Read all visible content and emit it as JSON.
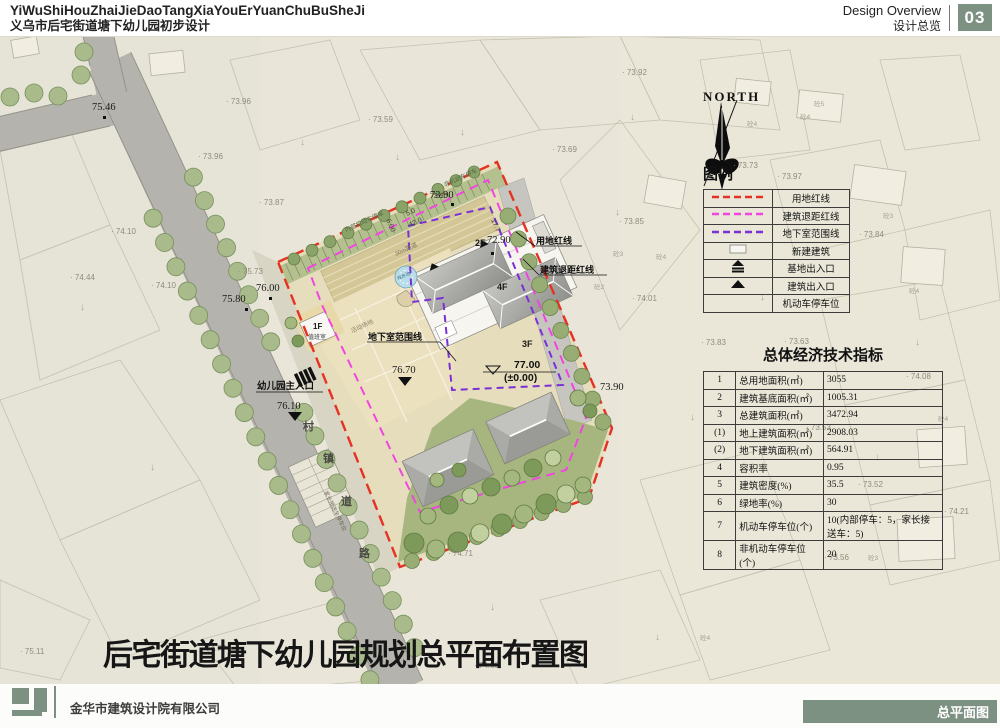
{
  "header": {
    "title_pinyin": "YiWuShiHouZhaiJieDaoTangXiaYouErYuanChuBuSheJi",
    "title_cn": "义乌市后宅街道塘下幼儿园初步设计",
    "section_en": "Design Overview",
    "section_cn": "设计总览",
    "page_no": "03"
  },
  "legend": {
    "title": "图例",
    "rows": [
      {
        "symbol": "red-dash",
        "label": "用地红线"
      },
      {
        "symbol": "magenta-dash",
        "label": "建筑退距红线"
      },
      {
        "symbol": "purple-dash",
        "label": "地下室范围线"
      },
      {
        "symbol": "new-building",
        "label": "新建建筑"
      },
      {
        "symbol": "site-entrance",
        "label": "基地出入口"
      },
      {
        "symbol": "building-entrance",
        "label": "建筑出入口"
      },
      {
        "symbol": "parking",
        "label": "机动车停车位"
      }
    ]
  },
  "indicators": {
    "title": "总体经济技术指标",
    "rows": [
      [
        "1",
        "总用地面积(㎡)",
        "3055"
      ],
      [
        "2",
        "建筑基底面积(㎡)",
        "1005.31"
      ],
      [
        "3",
        "总建筑面积(㎡)",
        "3472.94"
      ],
      [
        "(1)",
        "地上建筑面积(㎡)",
        "2908.03"
      ],
      [
        "(2)",
        "地下建筑面积(㎡)",
        "564.91"
      ],
      [
        "4",
        "容积率",
        "0.95"
      ],
      [
        "5",
        "建筑密度(%)",
        "35.5"
      ],
      [
        "6",
        "绿地率(%)",
        "30"
      ],
      [
        "7",
        "机动车停车位(个)",
        "10(内部停车：5，家长接送车：5)"
      ],
      [
        "8",
        "非机动车停车位(个)",
        "20"
      ]
    ]
  },
  "plan": {
    "title": "后宅街道塘下幼儿园规划总平面布置图",
    "north_label": "NORTH",
    "labels": [
      {
        "t": "NORTH",
        "x": 703,
        "y": 101,
        "s": 13,
        "r": 0,
        "c": "#111",
        "w": 700,
        "f": "serif",
        "ls": 2
      },
      {
        "t": "用地红线",
        "x": 536,
        "y": 244,
        "s": 9,
        "r": 0,
        "c": "#111",
        "w": 600
      },
      {
        "t": "建筑退距红线",
        "x": 540,
        "y": 273,
        "s": 9,
        "r": 0,
        "c": "#111",
        "w": 600
      },
      {
        "t": "地下室范围线",
        "x": 368,
        "y": 340,
        "s": 9,
        "r": 0,
        "c": "#111",
        "w": 700
      },
      {
        "t": "幼儿园主入口",
        "x": 257,
        "y": 389,
        "s": 9.5,
        "r": 0,
        "c": "#111",
        "w": 700
      },
      {
        "t": "活动场地",
        "x": 352,
        "y": 333,
        "s": 6,
        "r": -24.5,
        "c": "#8d8569",
        "w": 400
      },
      {
        "t": "30m跑道",
        "x": 396,
        "y": 256,
        "s": 6,
        "r": -24.5,
        "c": "#7c7659",
        "w": 400
      },
      {
        "t": "内部机动车停车",
        "x": 346,
        "y": 232,
        "s": 6,
        "r": -24.5,
        "c": "#55653f",
        "w": 400
      },
      {
        "t": "非机动车停车",
        "x": 445,
        "y": 187,
        "s": 6,
        "r": -24.5,
        "c": "#55653f",
        "w": 400
      },
      {
        "t": "家长接送车停车位",
        "x": 324,
        "y": 492,
        "s": 5.5,
        "r": 64,
        "c": "#6f6a55",
        "w": 400
      },
      {
        "t": "戏水池",
        "x": 398,
        "y": 280,
        "s": 4.5,
        "r": -24.5,
        "c": "#2e6577",
        "w": 400
      },
      {
        "t": "1F",
        "x": 313,
        "y": 329,
        "s": 8,
        "r": 0,
        "c": "#1a1a1a",
        "w": 700
      },
      {
        "t": "值班室",
        "x": 308,
        "y": 339,
        "s": 6,
        "r": 0,
        "c": "#444",
        "w": 400
      },
      {
        "t": "2F",
        "x": 475,
        "y": 246,
        "s": 9,
        "r": 0,
        "c": "#1a1a1a",
        "w": 700
      },
      {
        "t": "4F",
        "x": 497,
        "y": 290,
        "s": 9,
        "r": 0,
        "c": "#1a1a1a",
        "w": 700
      },
      {
        "t": "3F",
        "x": 522,
        "y": 347,
        "s": 9,
        "r": 0,
        "c": "#1a1a1a",
        "w": 700
      },
      {
        "t": "77.00",
        "x": 514,
        "y": 368,
        "s": 10.5,
        "r": 0,
        "c": "#111",
        "w": 700
      },
      {
        "t": "(±0.00)",
        "x": 504,
        "y": 381,
        "s": 10.5,
        "r": 0,
        "c": "#111",
        "w": 700
      }
    ],
    "spot_levels": [
      {
        "v": "75.46",
        "x": 92,
        "y": 110
      },
      {
        "v": "75.80",
        "x": 222,
        "y": 302
      },
      {
        "v": "76.00",
        "x": 256,
        "y": 291
      },
      {
        "v": "76.10",
        "x": 277,
        "y": 409
      },
      {
        "v": "76.70",
        "x": 392,
        "y": 373
      },
      {
        "v": "73.90",
        "x": 430,
        "y": 198
      },
      {
        "v": "72.90",
        "x": 487,
        "y": 243
      },
      {
        "v": "73.90",
        "x": 600,
        "y": 390
      }
    ],
    "bg_levels": [
      {
        "v": "· 73.96",
        "x": 226,
        "y": 104
      },
      {
        "v": "· 73.96",
        "x": 198,
        "y": 159
      },
      {
        "v": "· 73.87",
        "x": 259,
        "y": 205
      },
      {
        "v": "· 74.10",
        "x": 111,
        "y": 234
      },
      {
        "v": "· 74.44",
        "x": 70,
        "y": 280
      },
      {
        "v": "· 74.10",
        "x": 151,
        "y": 288
      },
      {
        "v": "· 75.73",
        "x": 238,
        "y": 274
      },
      {
        "v": "· 73.92",
        "x": 622,
        "y": 75
      },
      {
        "v": "· 73.59",
        "x": 368,
        "y": 122
      },
      {
        "v": "· 73.69",
        "x": 552,
        "y": 152
      },
      {
        "v": "· 73.73",
        "x": 733,
        "y": 168
      },
      {
        "v": "· 73.97",
        "x": 777,
        "y": 179
      },
      {
        "v": "· 73.84",
        "x": 859,
        "y": 237
      },
      {
        "v": "· 73.85",
        "x": 619,
        "y": 224
      },
      {
        "v": "· 74.01",
        "x": 632,
        "y": 301
      },
      {
        "v": "· 73.83",
        "x": 701,
        "y": 345
      },
      {
        "v": "· 73.63",
        "x": 784,
        "y": 344
      },
      {
        "v": "· 74.08",
        "x": 906,
        "y": 379
      },
      {
        "v": "· 73.53",
        "x": 806,
        "y": 430
      },
      {
        "v": "· 73.52",
        "x": 858,
        "y": 487
      },
      {
        "v": "· 74.21",
        "x": 944,
        "y": 514
      },
      {
        "v": "· 73.56",
        "x": 824,
        "y": 560
      },
      {
        "v": "· 74.71",
        "x": 448,
        "y": 556
      },
      {
        "v": "· 74.60",
        "x": 474,
        "y": 668
      },
      {
        "v": "· 74.77",
        "x": 201,
        "y": 651
      },
      {
        "v": "· 75.11",
        "x": 20,
        "y": 654
      }
    ],
    "bg_marks": [
      {
        "v": "砼4",
        "x": 747,
        "y": 126
      },
      {
        "v": "砼5",
        "x": 814,
        "y": 106
      },
      {
        "v": "砼4",
        "x": 800,
        "y": 119
      },
      {
        "v": "砼3",
        "x": 883,
        "y": 218
      },
      {
        "v": "砼4",
        "x": 909,
        "y": 293
      },
      {
        "v": "砼3",
        "x": 613,
        "y": 256
      },
      {
        "v": "砼4",
        "x": 656,
        "y": 259
      },
      {
        "v": "砼2",
        "x": 594,
        "y": 289
      },
      {
        "v": "砼4",
        "x": 938,
        "y": 421
      },
      {
        "v": "砼3",
        "x": 868,
        "y": 560
      },
      {
        "v": "砼4",
        "x": 700,
        "y": 640
      }
    ],
    "road_name": [
      {
        "v": "村",
        "x": 303,
        "y": 430
      },
      {
        "v": "镇",
        "x": 323,
        "y": 462
      },
      {
        "v": "道",
        "x": 341,
        "y": 505
      },
      {
        "v": "路",
        "x": 359,
        "y": 557
      }
    ],
    "dims": [
      {
        "v": "5.0",
        "x": 407,
        "y": 216,
        "r": -24.5
      },
      {
        "v": "42.0",
        "x": 410,
        "y": 227,
        "r": -24.5
      },
      {
        "v": "6.00",
        "x": 386,
        "y": 220,
        "r": 65.5
      },
      {
        "v": "17.7",
        "x": 491,
        "y": 220,
        "r": 65.5
      },
      {
        "v": "73.90",
        "x": 430,
        "y": 198,
        "r": 0
      }
    ]
  },
  "footer": {
    "company": "金华市建筑设计院有限公司",
    "sheet_label": "总平面图"
  },
  "colors": {
    "accent": "#7d9183",
    "redline": "#e53222",
    "setback": "#f046e0",
    "basement": "#7b2fd6"
  }
}
